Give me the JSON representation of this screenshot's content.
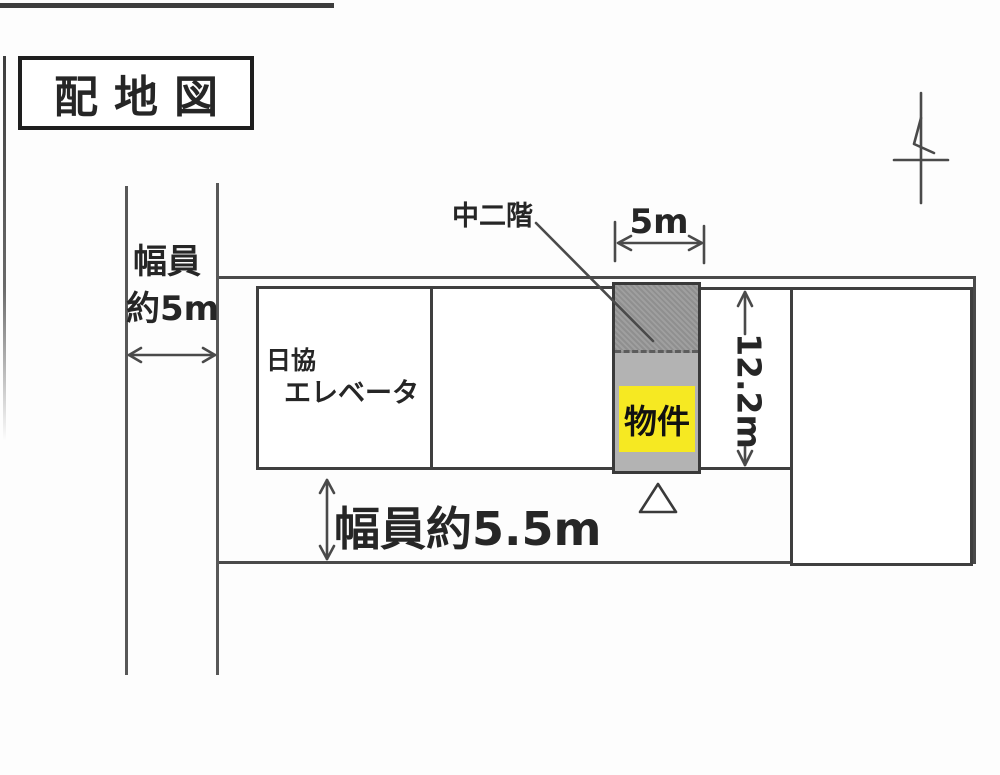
{
  "title": {
    "text": "配地図"
  },
  "roads": {
    "west_road": {
      "label_line1": "幅員",
      "label_line2": "約5m"
    },
    "south_road": {
      "label": "幅員約5.5m"
    }
  },
  "dimensions": {
    "frontage_width": "5m",
    "depth": "12.2m"
  },
  "buildings": {
    "elevator_company": {
      "name_line1": "日協",
      "name_line2": "エレベータ"
    },
    "property": {
      "label": "物件",
      "mezzanine_label": "中二階"
    }
  },
  "icons": {
    "north_arrow": "north-arrow",
    "entrance_triangle": "entrance-triangle"
  },
  "colors": {
    "highlight_yellow": "#f6e922",
    "mezzanine_gray": "#9a9a9a",
    "strip_gray": "#b3b3b3",
    "line_gray": "#4a4a4a"
  }
}
